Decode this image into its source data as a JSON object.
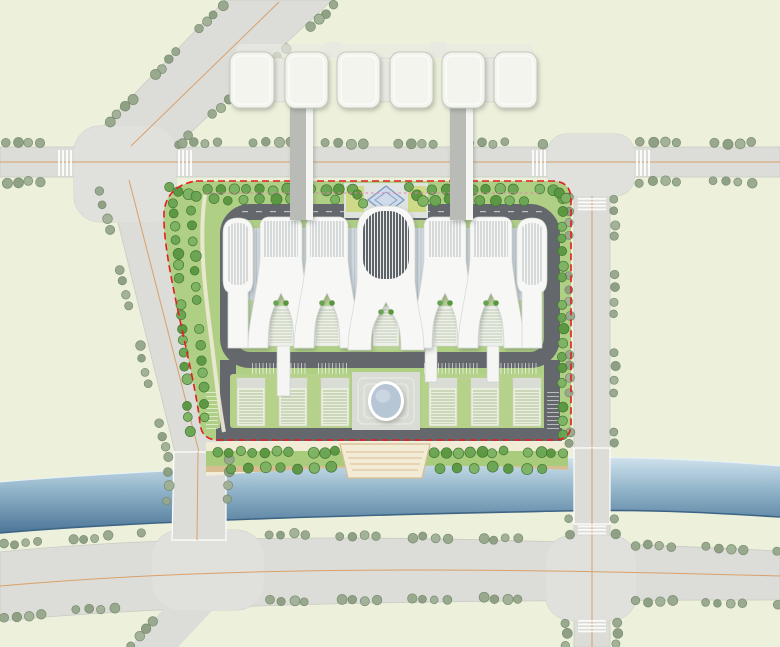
{
  "palette": {
    "land": "#edf1db",
    "road": "#dcddd8",
    "road_edge": "#c9cbc3",
    "intersection": "#e0e1dc",
    "centerline": "#d9a06b",
    "lane_dash": "#ffffff",
    "road_tree_fills": [
      "#96a78b",
      "#8b9d80",
      "#a0b095"
    ],
    "road_tree_edge": "#76876c",
    "site_tree_fills": [
      "#69a452",
      "#58963f",
      "#7cb262"
    ],
    "site_tree_edge": "#3f7430",
    "site_green": "#a5c878",
    "site_green_light": "#bcd694",
    "site_path": "#f0ead6",
    "ring_road": "#64686d",
    "building_white": "#f7f8f6",
    "building_edge": "#d4d7d2",
    "central_rib_bg": "#e9ebe8",
    "glass": "#d2dae1",
    "courtyard_green": "#b9d295",
    "pavilion": "#eef0ec",
    "campus_lawn": "#b6d28a",
    "terrace": "#e9eede",
    "terrace_cap": "#d9ddd6",
    "plaza": "#d9dbd5",
    "plaza_step": "#e6e8e2",
    "oval_fill": "#b7c6d4",
    "oval_ring": "#ffffff",
    "prom_path": "#f2ecd6",
    "prom_lawn": "#a9cb7c",
    "prom_edge": "#d9bd92",
    "river_top": "#cfe2ec",
    "river_mid": "#8fb2c8",
    "river_deep": "#4c7697",
    "river_line": "#3e6585",
    "boundary_red": "#e31e1e",
    "boundary_pink": "#e87fb4",
    "block_fill": "#f3f4ee",
    "block_edge": "#c6c8c0",
    "block_conn": "#e8eae2",
    "bridge_gray": "#b9bbb6",
    "bridge_white": "#f5f6f3",
    "entry_plaza": "#dfe3e0",
    "entry_diamond_fill": "#cfdbea",
    "entry_diamond_edge": "#7f9cc4",
    "entry_plant": "#cdd87e"
  },
  "scene": {
    "canvas": {
      "w": 780,
      "h": 647
    },
    "roads": {
      "top_road": {
        "x": 0,
        "y": 147,
        "w": 780,
        "h": 30
      },
      "right_road": {
        "x": 574,
        "y": 177,
        "w": 36,
        "h": 470
      },
      "diagonal_road": "225,0 332,0 172,150 86,144",
      "left_road": "107,178 153,178 226,452 225,542 172,542 175,452",
      "bottom_road_path": "M0,552 C180,534 420,533 780,551 L780,600 C420,600 180,604 0,621 Z",
      "left_stub": "173,598 224,598 178,647 130,647",
      "intersections": [
        {
          "x": 74,
          "y": 126,
          "w": 102,
          "h": 96,
          "r": 26
        },
        {
          "x": 548,
          "y": 134,
          "w": 86,
          "h": 62,
          "r": 18
        },
        {
          "x": 152,
          "y": 530,
          "w": 112,
          "h": 80,
          "r": 28
        },
        {
          "x": 546,
          "y": 536,
          "w": 90,
          "h": 84,
          "r": 24
        }
      ],
      "centerlines": [
        "M0,162 L780,162",
        "M279,2 L131,146",
        "M129,180 L199,452 L198,541",
        "M592,196 L592,647",
        "M0,586 C200,568 430,566 780,576"
      ],
      "crosswalks": [
        {
          "x": 58,
          "y": 150,
          "w": 14,
          "h": 26,
          "dir": "v"
        },
        {
          "x": 178,
          "y": 150,
          "w": 14,
          "h": 26,
          "dir": "v"
        },
        {
          "x": 532,
          "y": 150,
          "w": 14,
          "h": 26,
          "dir": "v"
        },
        {
          "x": 636,
          "y": 150,
          "w": 14,
          "h": 26,
          "dir": "v"
        },
        {
          "x": 578,
          "y": 198,
          "w": 28,
          "h": 12,
          "dir": "h"
        },
        {
          "x": 578,
          "y": 522,
          "w": 28,
          "h": 12,
          "dir": "h"
        },
        {
          "x": 578,
          "y": 620,
          "w": 28,
          "h": 12,
          "dir": "h"
        }
      ]
    },
    "river": {
      "path": "M0,482 C160,468 420,461 560,458 C640,456 720,461 780,466 L780,517 C700,512 640,509 560,511 C420,514 160,519 0,533 Z",
      "top_edge": "M0,482 C160,468 420,461 560,458 C640,456 720,461 780,466",
      "bottom_edge": "M780,517 C700,512 640,509 560,511 C420,514 160,519 0,533"
    },
    "river_bridges": [
      "174,452 226,452 226,540 172,540",
      "574,448 610,448 610,524 574,524"
    ],
    "bridge_centerlines": [
      "M198,452 L197,540",
      "M592,448 L592,524"
    ],
    "boundary": {
      "red_path": "M196,181 L552,181 Q571,181 571,200 L571,424 Q571,440 554,440 L218,440 Q202,440 200,424 C195,372 162,262 164,213 C165,196 176,184 196,181 Z",
      "pink_path": "M206,193 L540,193"
    },
    "site": {
      "ring_rect": {
        "x": 228,
        "y": 212,
        "w": 324,
        "h": 148,
        "r": 22,
        "sw": 16
      },
      "side_bands": [
        {
          "x": 220,
          "y": 360,
          "w": 16,
          "h": 72
        },
        {
          "x": 544,
          "y": 360,
          "w": 16,
          "h": 72
        }
      ],
      "bottom_site_road": {
        "x": 216,
        "y": 428,
        "w": 346,
        "h": 13
      },
      "lane_dash_row": {
        "y": 211,
        "x1": 242,
        "x2": 538
      },
      "parking_rows_bottom": [
        [
          252,
          306
        ],
        [
          318,
          348
        ],
        [
          424,
          478
        ],
        [
          490,
          538
        ]
      ],
      "parking_cols": [
        {
          "x": 206,
          "y1": 392,
          "y2": 428
        },
        {
          "x": 547,
          "y1": 392,
          "y2": 428
        }
      ],
      "entry_plaza": {
        "x": 344,
        "y": 183,
        "w": 84,
        "h": 35
      },
      "entry_diamond": "386,186 404,200 386,214 368,200",
      "entry_plants": [
        {
          "x": 346,
          "y": 186,
          "w": 18,
          "h": 26
        },
        {
          "x": 408,
          "y": 186,
          "w": 18,
          "h": 26
        }
      ],
      "left_path": "M205,195 C198,240 206,300 212,345 C216,380 220,410 224,432"
    },
    "building": {
      "glass_strip": {
        "x": 238,
        "y": 228,
        "w": 296,
        "h": 100
      },
      "green_strip": {
        "x": 238,
        "y": 300,
        "w": 296,
        "h": 46
      },
      "towers": [
        {
          "cx": 281
        },
        {
          "cx": 327
        },
        {
          "cx": 445
        },
        {
          "cx": 491
        }
      ],
      "tower_params": {
        "topY": 217,
        "topR": 10,
        "halfW": 21,
        "barBot": 260,
        "notchY": 293,
        "footOut": 33,
        "footIn": 13,
        "footY": 348
      },
      "central": {
        "cx": 386,
        "topY": 206,
        "topR": 26,
        "halfW": 29,
        "barBot": 282,
        "notchY": 302,
        "footOut": 38,
        "footIn": 15,
        "footY": 350
      },
      "pods": [
        {
          "cx": 238
        },
        {
          "cx": 532
        }
      ],
      "pod_params": {
        "topY": 218,
        "bodyBot": 290,
        "halfW": 15,
        "legHalf": 10,
        "footY": 348
      },
      "pavilion_w": 26,
      "pavilion_y": 306,
      "pavilion_h": 40
    },
    "campus": {
      "lawns": [
        {
          "x": 230,
          "y": 374,
          "w": 120,
          "h": 54
        },
        {
          "x": 422,
          "y": 374,
          "w": 120,
          "h": 54
        }
      ],
      "terraces_x": [
        237,
        279,
        321,
        429,
        471,
        513
      ],
      "terrace": {
        "y": 378,
        "w": 28,
        "h": 48,
        "capH": 10
      },
      "plaza": {
        "x": 352,
        "y": 372,
        "w": 68,
        "h": 58
      },
      "plaza_steps": [
        {
          "x": 358,
          "y": 378,
          "w": 56,
          "h": 46,
          "r": 6
        },
        {
          "x": 364,
          "y": 384,
          "w": 44,
          "h": 34,
          "r": 5
        }
      ],
      "oval": {
        "cx": 386,
        "cy": 401,
        "rx": 15,
        "ry": 17
      },
      "connectors": [
        {
          "x": 277,
          "y": 346,
          "w": 13,
          "h": 50
        },
        {
          "x": 425,
          "y": 346,
          "w": 12,
          "h": 36
        },
        {
          "x": 487,
          "y": 346,
          "w": 12,
          "h": 36
        }
      ]
    },
    "promenade": {
      "clip_path": "M206,442 L568,442 L568,470 C450,462 330,466 206,476 Z",
      "stripes": [
        {
          "y": 442,
          "h": 9,
          "c": "prom_path"
        },
        {
          "y": 451,
          "h": 15,
          "c": "prom_lawn"
        },
        {
          "y": 466,
          "h": 6,
          "c": "prom_edge"
        },
        {
          "y": 472,
          "h": 8,
          "c": "prom_path"
        }
      ],
      "plaza_poly": "340,444 430,444 422,478 348,478",
      "plaza_steps_y": [
        452,
        458,
        464,
        470
      ]
    },
    "top_blocks": {
      "y": 52,
      "h": 56,
      "r": 10,
      "blocks": [
        {
          "x": 230,
          "w": 44
        },
        {
          "x": 285,
          "w": 43
        },
        {
          "x": 337,
          "w": 43
        },
        {
          "x": 390,
          "w": 43
        },
        {
          "x": 442,
          "w": 43
        },
        {
          "x": 494,
          "w": 43
        }
      ],
      "connectors": [
        {
          "x": 272,
          "y": 58,
          "w": 15,
          "h": 44
        },
        {
          "x": 378,
          "y": 58,
          "w": 14,
          "h": 44
        },
        {
          "x": 483,
          "y": 58,
          "w": 14,
          "h": 44
        }
      ],
      "tabs": [
        {
          "x": 324,
          "y": 42,
          "w": 18,
          "h": 16
        },
        {
          "x": 429,
          "y": 42,
          "w": 18,
          "h": 16
        }
      ],
      "back_slab": {
        "x": 236,
        "y": 44,
        "w": 298,
        "h": 14,
        "r": 7
      }
    },
    "sky_bridges": [
      {
        "x": 290,
        "y": 104,
        "h": 116
      },
      {
        "x": 450,
        "y": 104,
        "h": 116
      }
    ],
    "tree_lines": {
      "road": [
        [
          222,
          6,
          94,
          138,
          11
        ],
        [
          334,
          6,
          180,
          144,
          11
        ],
        [
          6,
          143,
          62,
          143,
          12
        ],
        [
          182,
          143,
          542,
          143,
          12
        ],
        [
          640,
          143,
          776,
          143,
          12
        ],
        [
          6,
          182,
          62,
          182,
          12
        ],
        [
          640,
          182,
          776,
          182,
          12
        ],
        [
          100,
          192,
          166,
          448,
          13
        ],
        [
          570,
          198,
          570,
          444,
          13
        ],
        [
          615,
          198,
          615,
          444,
          13
        ],
        [
          4,
          545,
          142,
          534,
          12
        ],
        [
          270,
          534,
          542,
          540,
          12
        ],
        [
          636,
          545,
          778,
          550,
          12
        ],
        [
          4,
          617,
          138,
          606,
          12
        ],
        [
          270,
          601,
          542,
          598,
          12
        ],
        [
          636,
          601,
          778,
          604,
          12
        ],
        [
          570,
          518,
          570,
          534,
          11
        ],
        [
          615,
          518,
          615,
          534,
          11
        ],
        [
          566,
          622,
          566,
          645,
          11
        ],
        [
          617,
          622,
          617,
          645,
          11
        ],
        [
          152,
          620,
          132,
          645,
          11
        ],
        [
          168,
          458,
          168,
          528,
          13
        ],
        [
          228,
          458,
          228,
          528,
          13
        ]
      ],
      "site": [
        [
          208,
          190,
          338,
          190,
          13
        ],
        [
          432,
          190,
          540,
          190,
          13
        ],
        [
          214,
          200,
          336,
          200,
          15
        ],
        [
          434,
          200,
          540,
          200,
          15
        ],
        [
          174,
          202,
          190,
          430,
          13
        ],
        [
          192,
          212,
          206,
          418,
          15
        ],
        [
          563,
          200,
          563,
          434,
          13
        ],
        [
          218,
          452,
          336,
          452,
          12
        ],
        [
          434,
          452,
          564,
          452,
          12
        ],
        [
          232,
          468,
          330,
          468,
          17
        ],
        [
          440,
          468,
          560,
          468,
          17
        ],
        [
          352,
          188,
          364,
          202,
          9
        ],
        [
          410,
          188,
          422,
          202,
          9
        ],
        [
          552,
          190,
          566,
          198,
          8
        ],
        [
          170,
          188,
          196,
          196,
          9
        ]
      ]
    }
  }
}
